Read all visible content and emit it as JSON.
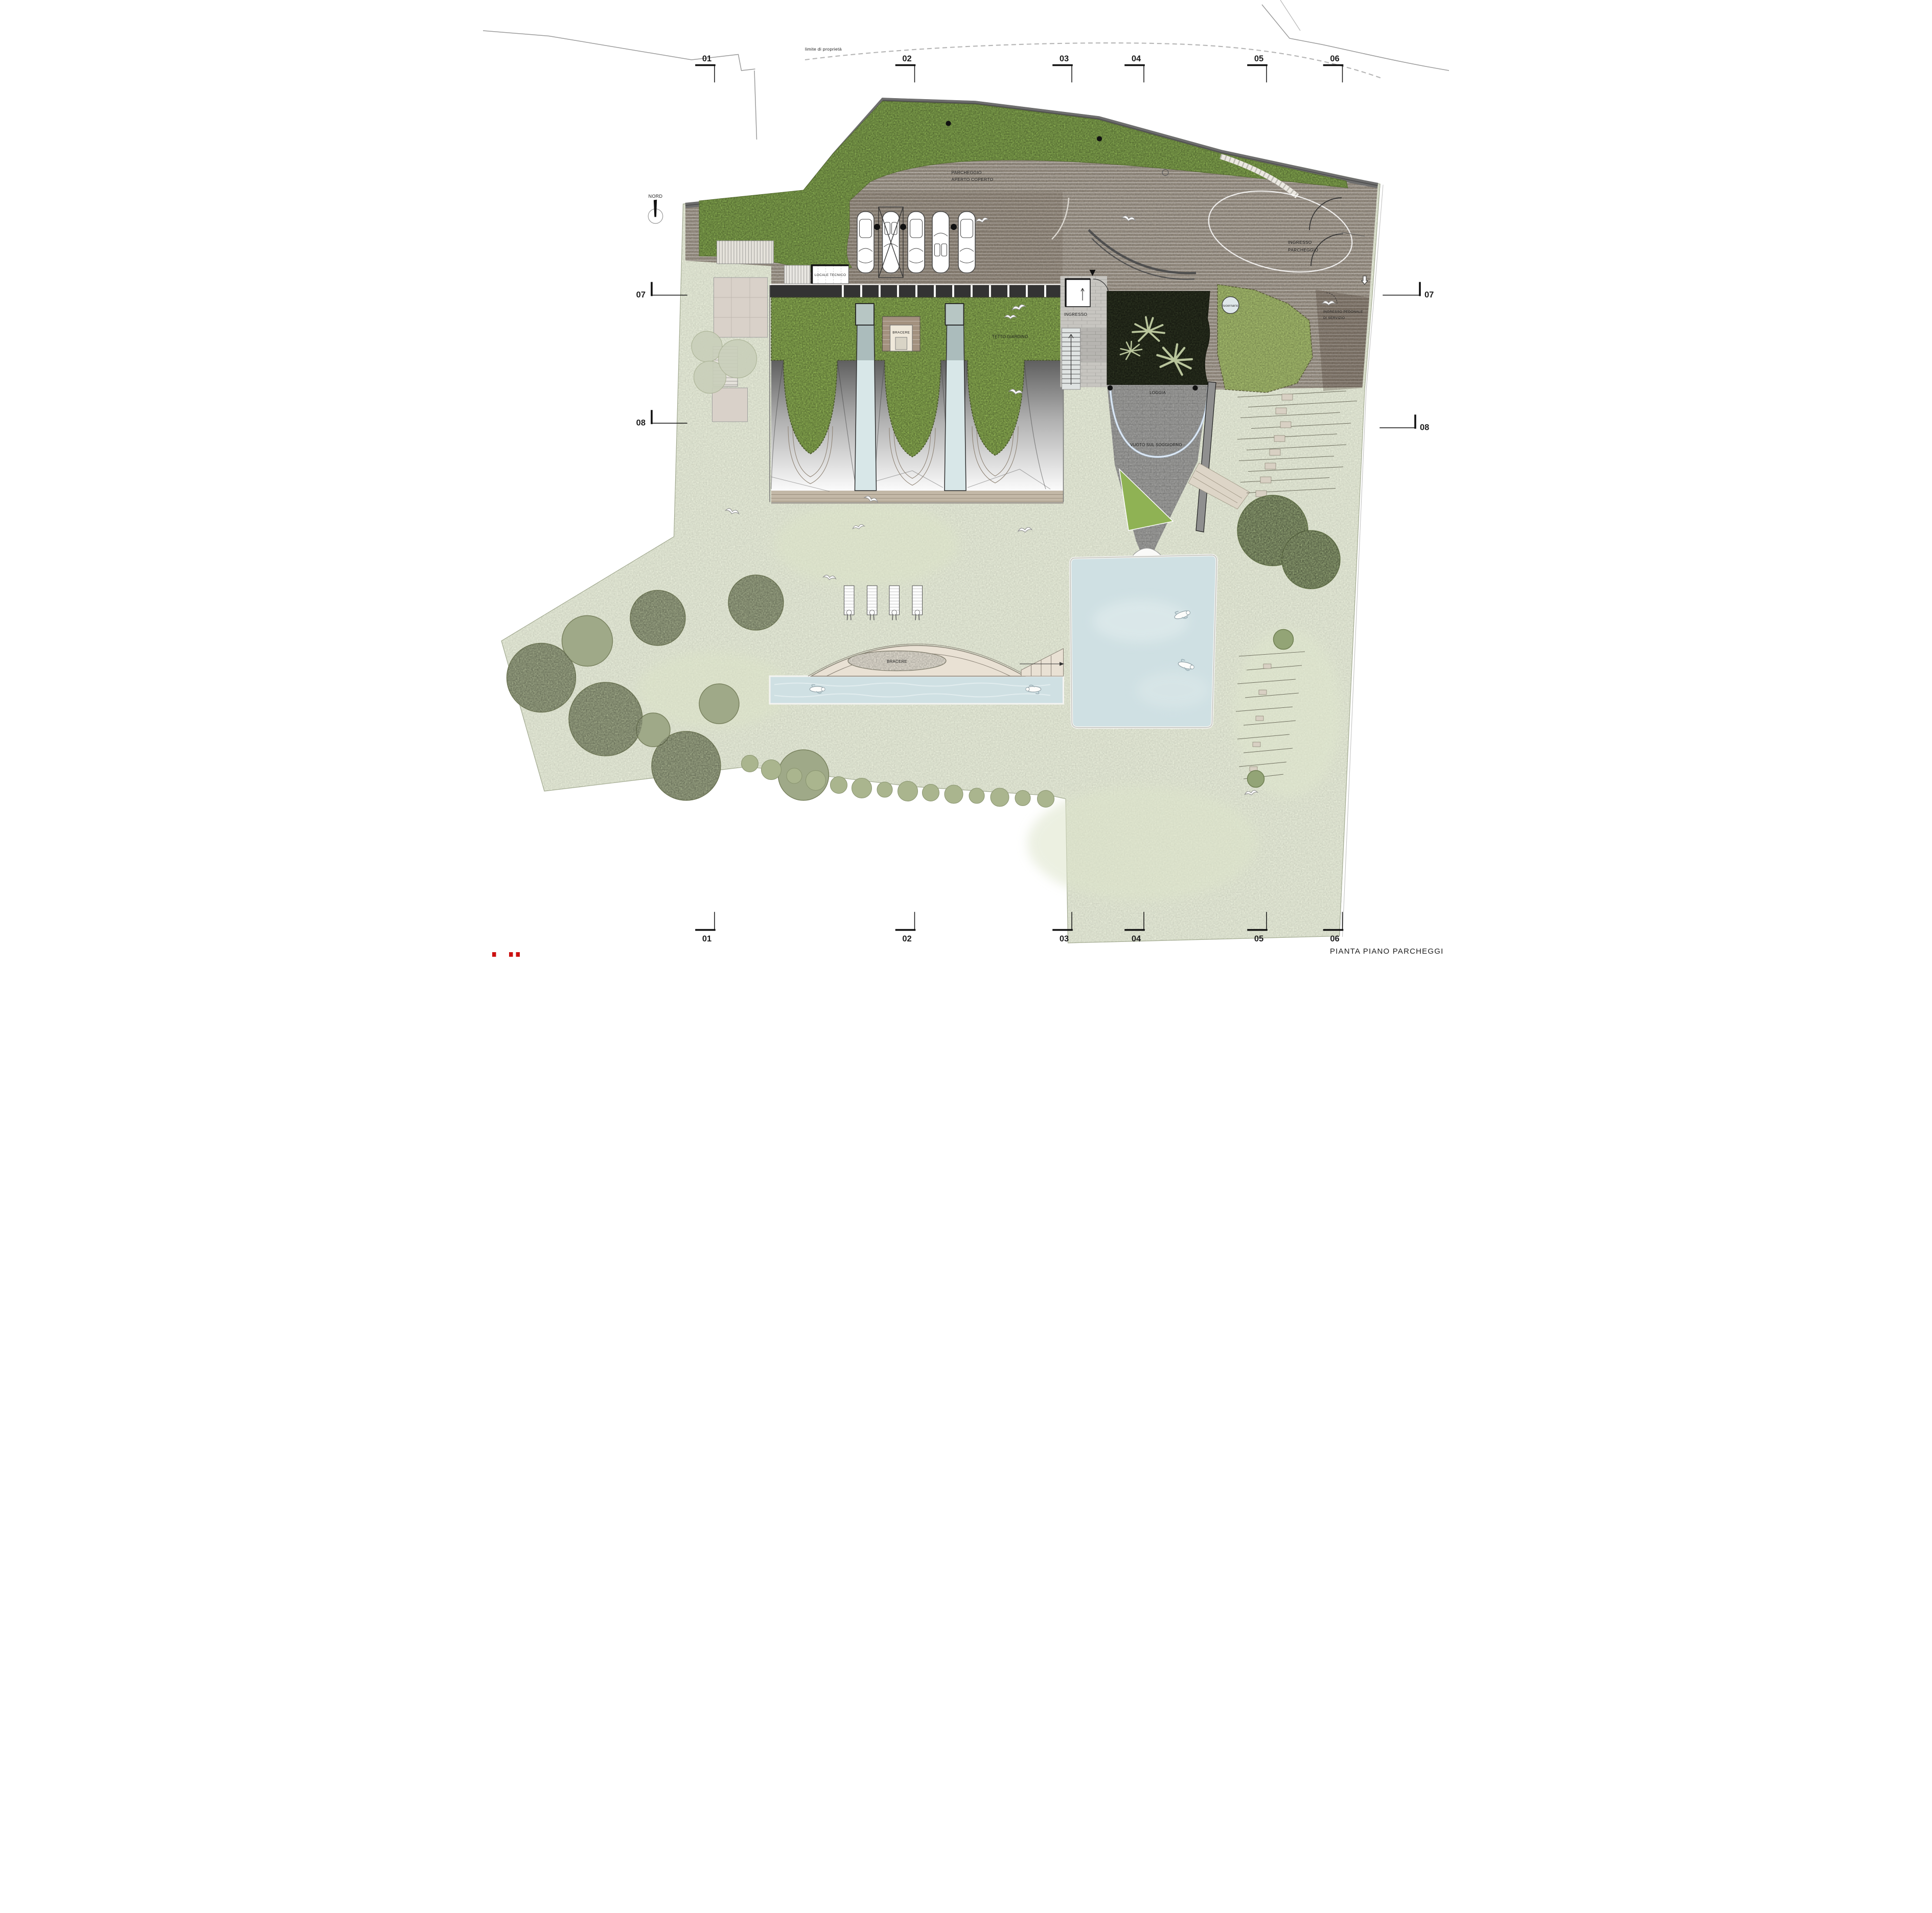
{
  "drawing": {
    "title": "PIANTA PIANO PARCHEGGI",
    "north_label": "NORD",
    "boundary_label": "limite di proprietà"
  },
  "grid": {
    "top": [
      "01",
      "02",
      "03",
      "04",
      "05",
      "06"
    ],
    "bottom": [
      "01",
      "02",
      "03",
      "04",
      "05",
      "06"
    ],
    "left": [
      "07",
      "08"
    ],
    "right": [
      "07",
      "08"
    ]
  },
  "areas": {
    "parcheggio_line1": "PARCHEGGIO",
    "parcheggio_line2": "APERTO COPERTO",
    "ingresso_parcheggio_line1": "INGRESSO",
    "ingresso_parcheggio_line2": "PARCHEGGIO",
    "locale_tecnico": "LOCALE TECNICO",
    "tetto_giardino": "TETTO GIARDINO",
    "bracere_roof": "BRACERE",
    "ingresso": "INGRESSO",
    "lucernario": "lucernario",
    "ingresso_pedonale_line1": "INGRESSO PEDONALE",
    "ingresso_pedonale_line2": "DI SERVIZIO",
    "loggia": "LOGGIA",
    "vuoto_soggiorno": "VUOTO SUL SOGGIORNO",
    "bracere_garden": "BRACERE"
  },
  "colors": {
    "lawn": "#e7ecd9",
    "grass_band": "#87ab51",
    "roof_garden": "#8fb254",
    "grass_right": "#a8bf6f",
    "deck": "#9d9488",
    "wall": "#6e6e6e",
    "courtyard_dark": "#2e3522",
    "palm": "#b9c59c",
    "water": "#cfe0e3",
    "stone_tiles": "#a2a2a0",
    "terrace_cream": "#e9e1d4",
    "metal_dark": "#5f5f5f",
    "metal_light": "#fbfbfb",
    "tree_olive": "#9fa988",
    "tree_right": "#93a476",
    "mark_red": "#cc1111"
  }
}
